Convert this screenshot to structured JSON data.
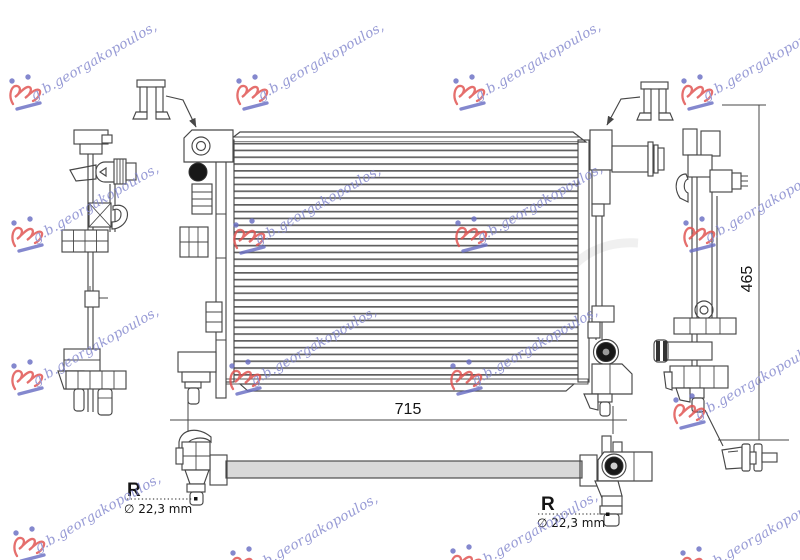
{
  "watermark": {
    "text": "g.b.georgakopoulos,"
  },
  "dimensions": {
    "width_mm": "715",
    "height_mm": "465"
  },
  "callouts": {
    "left": {
      "ref": "R",
      "diameter": "∅ 22,3 mm"
    },
    "right": {
      "ref": "R",
      "diameter": "∅ 22,3 mm"
    }
  },
  "colors": {
    "line": "#474747",
    "bottom_bar_fill": "#d9d9d9",
    "watermark_text": "#8084cc",
    "logo_red": "#e0504e",
    "logo_blue": "#6a6fc4"
  }
}
